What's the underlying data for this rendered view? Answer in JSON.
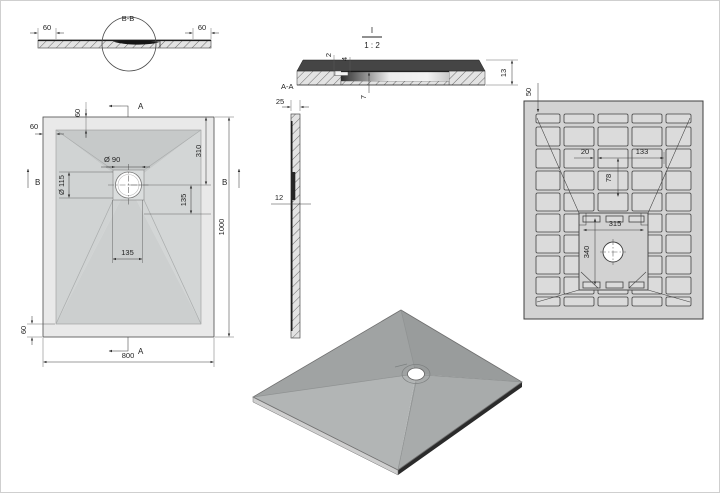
{
  "colors": {
    "line": "#3f3f3f",
    "body_light": "#e9e9e9",
    "body_mid": "#d2d2d2",
    "dark_band": "#454545",
    "white": "#ffffff"
  },
  "views": {
    "section_b_strip": {
      "name_label": "B-B",
      "dim_left": "60",
      "dim_right": "60"
    },
    "plan": {
      "marker_top": "A",
      "marker_bottom": "A",
      "marker_left": "B",
      "marker_right": "B",
      "dim_top_margin": "60",
      "dim_left_margin": "60",
      "dim_bottom_margin": "60",
      "dim_drain_dia": "Ø 90",
      "dim_flange_dia": "Ø 115",
      "dim_drain_top": "310",
      "dim_drain_right": "135",
      "dim_drain_bottom": "135",
      "dim_width": "800",
      "dim_height": "1000"
    },
    "detail": {
      "title": "I",
      "scale": "1 : 2",
      "section_label": "A-A",
      "dim_skin": "2",
      "dim_step": "4",
      "dim_recess": "7",
      "dim_thickness": "13"
    },
    "side": {
      "dim_top": "25",
      "dim_mid": "12"
    },
    "bottom": {
      "dim_edge": "50",
      "dim_rib": "20",
      "dim_pocket": "133",
      "dim_vert": "78",
      "dim_center_w": "315",
      "dim_center_h": "340"
    }
  }
}
